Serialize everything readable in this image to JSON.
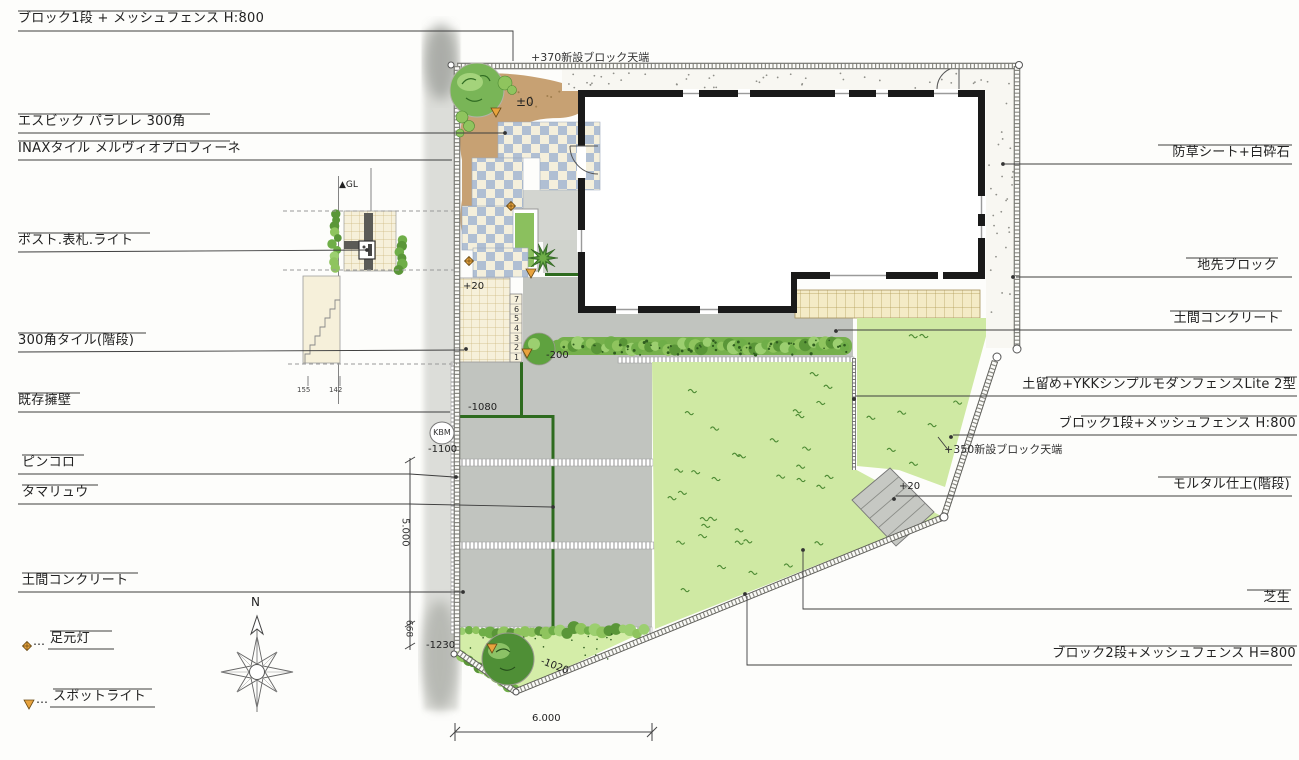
{
  "drawing": {
    "labels_left": [
      {
        "text": "ブロック1段 + メッシュフェンス H:800"
      },
      {
        "text": "エスビック パラレレ 300角"
      },
      {
        "text": "INAXタイル メルヴィオプロフィーネ"
      },
      {
        "text": "ポスト.表札.ライト"
      },
      {
        "text": "300角タイル(階段)"
      },
      {
        "text": "既存擁壁"
      },
      {
        "text": "ピンコロ"
      },
      {
        "text": "タマリュウ"
      },
      {
        "text": "土間コンクリート"
      }
    ],
    "labels_right": [
      {
        "text": "防草シート+白砕石"
      },
      {
        "text": "地先ブロック"
      },
      {
        "text": "土間コンクリート"
      },
      {
        "text": "土留め+YKKシンプルモダンフェンスLite 2型"
      },
      {
        "text": "ブロック1段+メッシュフェンス H:800"
      },
      {
        "text": "モルタル仕上(階段)"
      },
      {
        "text": "芝生"
      },
      {
        "text": "ブロック2段+メッシュフェンス H=800"
      }
    ],
    "notes": {
      "top_wall": "+370新設ブロック天端",
      "right_wall": "+350新設ブロック天端"
    },
    "legend": [
      {
        "symbol": "foot-light-diamond",
        "text": "足元灯"
      },
      {
        "symbol": "spotlight-triangle",
        "text": "スポットライト"
      }
    ],
    "levels": {
      "entry": "±0",
      "tile_steps": "+20",
      "hedge": "-200",
      "drive_upper": "-1080",
      "kbm": "KBM",
      "kbm_level": "-1100",
      "bed": "-1230",
      "fence_base": "-1020",
      "mortar_steps": "+20"
    },
    "dimensions": {
      "left_main": "5.000",
      "left_lower": "668",
      "bottom": "6.000"
    },
    "compass": {
      "north": "N"
    },
    "detail_inset": {
      "gl": "▲GL",
      "dim_a": "155",
      "dim_b": "142"
    },
    "stair_numbers": [
      "7",
      "6",
      "5",
      "4",
      "3",
      "2",
      "1"
    ],
    "ellipsis": "…",
    "colors": {
      "lawn": "#cfe9a3",
      "bed_lawn": "#d4eda8",
      "hedge": "#76b04c",
      "hedge_dark": "#2f5d1f",
      "soil": "#c49c6b",
      "checker_blue": "#b0bfd3",
      "checker_cream": "#f4efdc",
      "tile_cream": "#f6f0da",
      "tan_block": "#f4ebc6",
      "concrete": "#c1c4bf",
      "gravel": "#f8f7f2",
      "road": "#d2d3ce",
      "wall_black": "#1a1a1a",
      "tree_dark": "#4f8f36",
      "tree_mid": "#79b557",
      "tree_light": "#a9d67f",
      "accent_orange": "#e8a33d",
      "line": "#444444"
    }
  }
}
